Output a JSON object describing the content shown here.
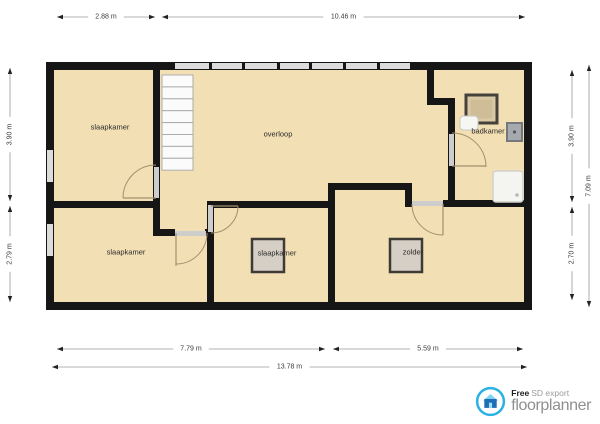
{
  "branding": {
    "free_label": "Free",
    "export_label": "SD export",
    "name": "floorplanner"
  },
  "plan": {
    "colors": {
      "floor": "#F2DFB4",
      "wall": "#161616",
      "window": "#DCDCDC",
      "opening": "#CDCDCD",
      "stair_fill": "#FBFBFB",
      "stair_border": "#ADADAD",
      "door_arc": "#A3906E",
      "fixture_fill": "#D5CFC5",
      "fixture_border": "#3E3A35",
      "shower_fill": "#DAC9A5",
      "shower_inner": "#CFBD98",
      "toilet_fill": "#F6F6F3",
      "toilet_border": "#C9C9C3",
      "sink_fill": "#A6AAAE",
      "sink_border": "#74787D",
      "sink_dot": "#55585C",
      "tray_fill": "#F4F4F1",
      "tray_border": "#D2D2CC",
      "tray_dot": "#BABAB4",
      "dim_line": "#9A9A9A",
      "dim_text": "#3A3A3A",
      "label_text": "#2B2B2B",
      "logo_ring": "#29B2E3",
      "logo_house_body": "#1D6FB5",
      "logo_house_roof": "#7ED3F2"
    },
    "floor": [
      46,
      62,
      486,
      248
    ],
    "walls": [
      [
        46,
        62,
        486,
        8
      ],
      [
        46,
        302,
        486,
        8
      ],
      [
        46,
        62,
        8,
        248
      ],
      [
        524,
        62,
        8,
        248
      ],
      [
        153,
        66,
        7,
        139
      ],
      [
        50,
        201,
        110,
        7
      ],
      [
        153,
        201,
        7,
        35
      ],
      [
        158,
        229,
        17,
        7
      ],
      [
        205,
        229,
        9,
        7
      ],
      [
        207,
        201,
        7,
        101
      ],
      [
        207,
        201,
        128,
        7
      ],
      [
        328,
        185,
        7,
        117
      ],
      [
        328,
        183,
        84,
        7
      ],
      [
        405,
        183,
        7,
        24
      ],
      [
        443,
        200,
        81,
        7
      ],
      [
        427,
        62,
        7,
        43
      ],
      [
        427,
        98,
        28,
        7
      ],
      [
        448,
        98,
        7,
        102
      ]
    ],
    "windows": [
      [
        175,
        63,
        235,
        6
      ],
      [
        47,
        150,
        6,
        32
      ],
      [
        47,
        224,
        6,
        32
      ]
    ],
    "window_dividers": [
      209,
      242,
      277,
      309,
      343,
      377
    ],
    "door_openings": [
      [
        154,
        167,
        5,
        31
      ],
      [
        175,
        231,
        31,
        5
      ],
      [
        208,
        205,
        5,
        27
      ],
      [
        412,
        201,
        31,
        5
      ],
      [
        449,
        134,
        5,
        32
      ]
    ],
    "doors": [
      {
        "leaf": "M156 198 L123 198",
        "arc": "M156 165 A33 33 0 0 0 123 198"
      },
      {
        "leaf": "M176 233 L176 266",
        "arc": "M207 233 A31 31 0 0 1 176 264"
      },
      {
        "leaf": "M211 206 L238 206",
        "arc": "M238 206 A27 27 0 0 1 211 233"
      },
      {
        "leaf": "M443 204 L443 235",
        "arc": "M412 204 A31 31 0 0 0 443 235"
      },
      {
        "leaf": "M452 166 L486 166",
        "arc": "M452 133 A34 34 0 0 1 486 167"
      }
    ],
    "stairs": {
      "x": 162,
      "y": 75,
      "width": 31,
      "tread_height": 11.9,
      "count": 8
    },
    "fixtures": [
      {
        "type": "storage-square",
        "rect": [
          252,
          239,
          32,
          33
        ]
      },
      {
        "type": "storage-square",
        "rect": [
          390,
          239,
          32,
          33
        ]
      },
      {
        "type": "shower",
        "rect": [
          466,
          95,
          31,
          28
        ]
      },
      {
        "type": "toilet",
        "rect": [
          460,
          116,
          18,
          14
        ]
      },
      {
        "type": "sink",
        "rect": [
          507,
          123,
          15,
          18
        ]
      },
      {
        "type": "shower-tray",
        "rect": [
          493,
          171,
          30,
          31
        ]
      }
    ],
    "rooms": [
      {
        "label": "slaapkamer",
        "x": 110,
        "y": 127
      },
      {
        "label": "overloop",
        "x": 278,
        "y": 134
      },
      {
        "label": "badkamer",
        "x": 488,
        "y": 131
      },
      {
        "label": "slaapkamer",
        "x": 126,
        "y": 252
      },
      {
        "label": "slaapkamer",
        "x": 277,
        "y": 253
      },
      {
        "label": "zolder",
        "x": 413,
        "y": 252
      }
    ],
    "dimensions": [
      {
        "orient": "h",
        "from": 57,
        "to": 155,
        "at": 17,
        "label": "2.88 m"
      },
      {
        "orient": "h",
        "from": 162,
        "to": 525,
        "at": 17,
        "label": "10.46 m"
      },
      {
        "orient": "h",
        "from": 57,
        "to": 325,
        "at": 349,
        "label": "7.79 m"
      },
      {
        "orient": "h",
        "from": 333,
        "to": 523,
        "at": 349,
        "label": "5.59 m"
      },
      {
        "orient": "h",
        "from": 52,
        "to": 527,
        "at": 367,
        "label": "13.78 m"
      },
      {
        "orient": "v",
        "from": 68,
        "to": 201,
        "at": 10,
        "label": "3.90 m"
      },
      {
        "orient": "v",
        "from": 206,
        "to": 302,
        "at": 10,
        "label": "2.79 m"
      },
      {
        "orient": "v",
        "from": 70,
        "to": 202,
        "at": 572,
        "label": "3.90 m"
      },
      {
        "orient": "v",
        "from": 207,
        "to": 300,
        "at": 572,
        "label": "2.70 m"
      },
      {
        "orient": "v",
        "from": 65,
        "to": 307,
        "at": 589,
        "label": "7.09 m"
      }
    ]
  }
}
